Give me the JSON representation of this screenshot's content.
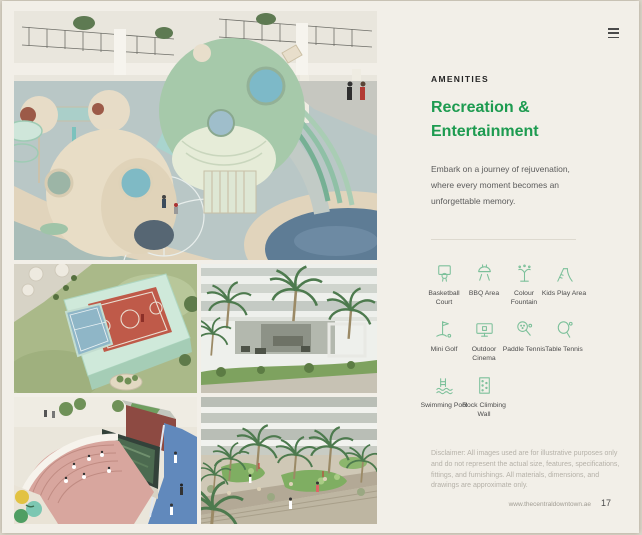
{
  "page": {
    "background_color": "#f2efe8",
    "accent_color": "#1d9b50",
    "footer": {
      "url": "www.thecentraldowntown.ae",
      "page_number": "17"
    }
  },
  "header": {
    "menu_icon": "hamburger"
  },
  "panel": {
    "kicker": "AMENITIES",
    "title": "Recreation & Entertainment",
    "description": "Embark on a journey of rejuvenation, where every moment becomes an unforgettable memory.",
    "disclaimer": "Disclaimer: All images used are for illustrative purposes only and do not represent the actual size, features, specifications, fittings, and furnishings. All materials, dimensions, and drawings are approximate only."
  },
  "amenities": {
    "icon_color": "#7cc09a",
    "items": [
      {
        "label": "Basketball Court",
        "icon": "basketball-court-icon"
      },
      {
        "label": "BBQ Area",
        "icon": "bbq-area-icon"
      },
      {
        "label": "Colour Fountain",
        "icon": "colour-fountain-icon"
      },
      {
        "label": "Kids Play Area",
        "icon": "kids-play-area-icon"
      },
      {
        "label": "Mini Golf",
        "icon": "mini-golf-icon"
      },
      {
        "label": "Outdoor Cinema",
        "icon": "outdoor-cinema-icon"
      },
      {
        "label": "Paddle Tennis",
        "icon": "paddle-tennis-icon"
      },
      {
        "label": "Table Tennis",
        "icon": "table-tennis-icon"
      },
      {
        "label": "Swimming Pool",
        "icon": "swimming-pool-icon"
      },
      {
        "label": "Rock Climbing Wall",
        "icon": "rock-climbing-wall-icon"
      }
    ]
  },
  "photos": [
    {
      "name": "kids-playground-render"
    },
    {
      "name": "sports-courts-render"
    },
    {
      "name": "building-terrace-render"
    },
    {
      "name": "amphitheatre-outdoor-cinema-render"
    },
    {
      "name": "courtyard-mini-golf-render"
    }
  ]
}
